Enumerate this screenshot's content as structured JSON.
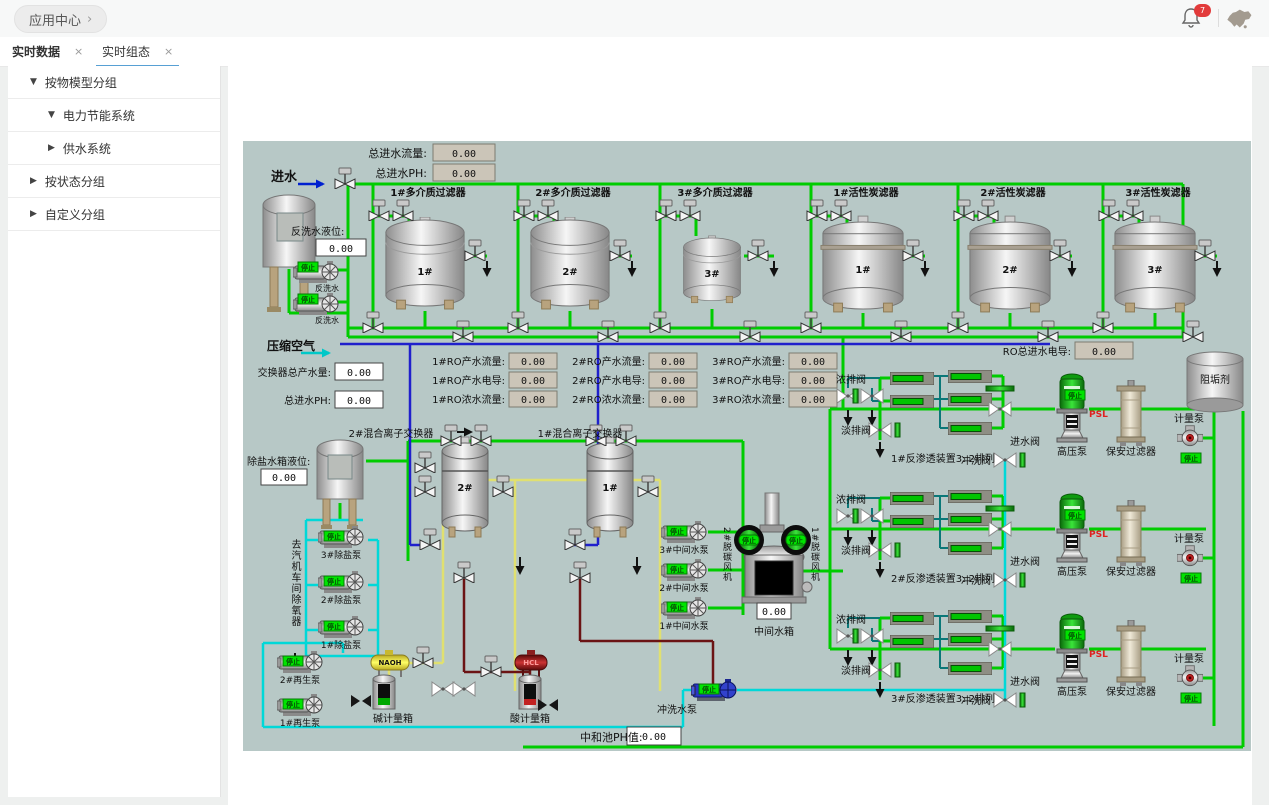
{
  "header": {
    "app_center": "应用中心",
    "chevron": "›",
    "bell_badge": "7"
  },
  "icons": {
    "close": "×"
  },
  "tabs": [
    {
      "label": "实时数据"
    },
    {
      "label": "实时组态"
    }
  ],
  "sidebar": {
    "items": [
      {
        "chevron": "▼",
        "label": "按物模型分组"
      },
      {
        "chevron": "▼",
        "label": "电力节能系统"
      },
      {
        "chevron": "▶",
        "label": "供水系统"
      },
      {
        "chevron": "▶",
        "label": "按状态分组"
      },
      {
        "chevron": "▶",
        "label": "自定义分组"
      }
    ]
  },
  "scada": {
    "colors": {
      "panel_bg": "#b7c8c6",
      "pipe_green": "#00cc00",
      "pipe_blue": "#2020cc",
      "pipe_cyan": "#00d8d8",
      "pipe_yellow": "#e0e070",
      "pipe_maroon": "#6b1414",
      "stop_bg": "#00e400"
    },
    "labels": {
      "inlet": "进水",
      "total_inlet_flow": "总进水流量:",
      "total_inlet_ph": "总进水PH:",
      "backwash_level": "反洗水液位:",
      "backwash_water": "反洗水",
      "compressed_air": "压缩空气",
      "exchanger_total_flow": "交换器总产水量:",
      "inlet_ph2": "总进水PH:",
      "mm_filter_1": "1#多介质过滤器",
      "mm_filter_2": "2#多介质过滤器",
      "mm_filter_3": "3#多介质过滤器",
      "ac_filter_1": "1#活性炭滤器",
      "ac_filter_2": "2#活性炭滤器",
      "ac_filter_3": "3#活性炭滤器",
      "tank_1": "1#",
      "tank_2": "2#",
      "tank_3": "3#",
      "ro1_product_flow": "1#RO产水流量:",
      "ro1_conductivity": "1#RO产水电导:",
      "ro1_concentrate_flow": "1#RO浓水流量:",
      "ro2_product_flow": "2#RO产水流量:",
      "ro2_conductivity": "2#RO产水电导:",
      "ro2_concentrate_flow": "2#RO浓水流量:",
      "ro3_product_flow": "3#RO产水流量:",
      "ro3_conductivity": "3#RO产水电导:",
      "ro3_concentrate_flow": "3#RO浓水流量:",
      "ro_total_inlet_cond": "RO总进水电导:",
      "scale_inhibitor": "阻垢剂",
      "metering_pump": "计量泵",
      "hp_pump": "高压泵",
      "security_filter": "保安过滤器",
      "psl": "PSL",
      "stop": "停止",
      "conc_valve": "浓排阀",
      "perm_valve": "淡排阀",
      "inlet_valve": "进水阀",
      "flush_valve": "冲洗阀",
      "ro_unit_1": "1#反渗透装置3: 2排列",
      "ro_unit_2": "2#反渗透装置3: 2排列",
      "ro_unit_3": "3#反渗透装置3: 2排列",
      "ion_exchanger_2": "2#混合离子交换器",
      "ion_exchanger_1": "1#混合离子交换器",
      "demin_tank_level": "除盐水箱液位:",
      "to_deaerator": "去汽机车间除氧器",
      "demin_pump_3": "3#除盐泵",
      "demin_pump_2": "2#除盐泵",
      "demin_pump_1": "1#除盐泵",
      "regen_pump_2": "2#再生泵",
      "regen_pump_1": "1#再生泵",
      "naoh": "NAOH",
      "hcl": "HCL",
      "alkali_tank": "碱计量箱",
      "acid_tank": "酸计量箱",
      "mid_pump_3": "3#中间水泵",
      "mid_pump_2": "2#中间水泵",
      "mid_pump_1": "1#中间水泵",
      "decarb_fan_2": "2#脱碳风机",
      "decarb_fan_1": "1#脱碳风机",
      "mid_tank": "中间水箱",
      "flush_pump": "冲洗水泵",
      "neutral_ph": "中和池PH值:"
    },
    "values": {
      "total_inlet_flow": "0.00",
      "total_inlet_ph": "0.00",
      "backwash_level": "0.00",
      "exchanger_total_flow": "0.00",
      "inlet_ph2": "0.00",
      "ro1_product_flow": "0.00",
      "ro1_conductivity": "0.00",
      "ro1_concentrate_flow": "0.00",
      "ro2_product_flow": "0.00",
      "ro2_conductivity": "0.00",
      "ro2_concentrate_flow": "0.00",
      "ro3_product_flow": "0.00",
      "ro3_conductivity": "0.00",
      "ro3_concentrate_flow": "0.00",
      "ro_total_inlet_cond": "0.00",
      "demin_tank_level": "0.00",
      "mid_tank_level": "0.00",
      "neutral_ph": "0.00"
    }
  }
}
